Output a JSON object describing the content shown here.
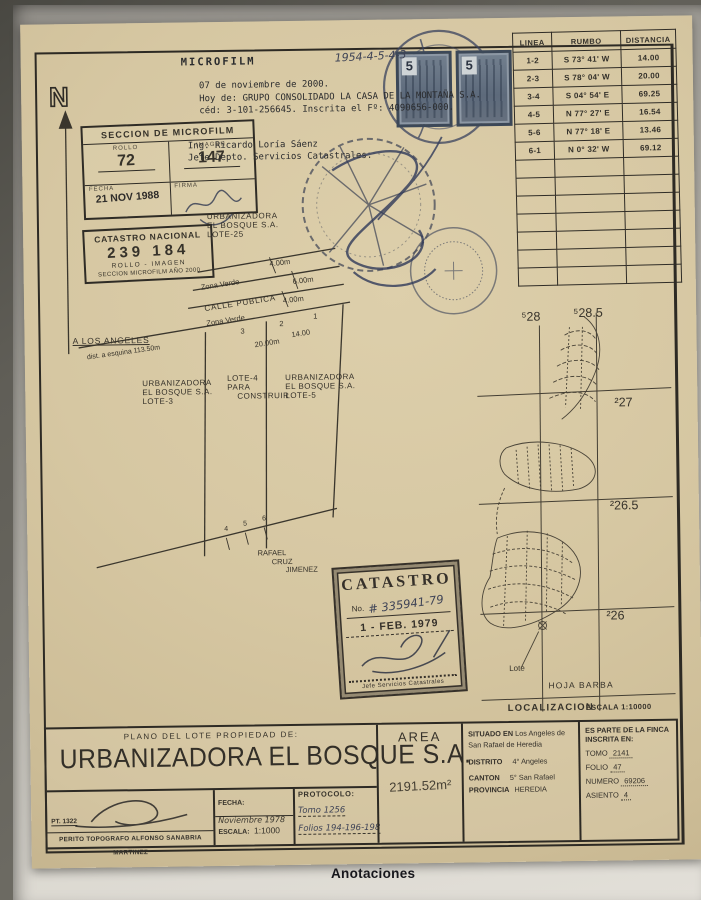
{
  "scan": {
    "annotations_heading": "Anotaciones"
  },
  "header": {
    "microfilm_label": "MICROFILM",
    "handwritten_code": "1954-4-5-4-3",
    "note_lines": [
      "07 de noviembre de 2000.",
      "Hoy de: GRUPO CONSOLIDADO LA CASA DE LA MONTAÑA S.A.",
      "céd: 3-101-256645. Inscrita el Fº: 4090656-000."
    ],
    "engineer_lines": [
      "Ing. Ricardo Loría Sáenz",
      "Jefe Depto. Servicios Catastrales."
    ]
  },
  "revenue_stamps": {
    "denomination": "5"
  },
  "microfilm_box": {
    "title": "SECCION DE MICROFILM",
    "rollo_label": "ROLLO",
    "rollo": "72",
    "imagen_label": "IMAGEN",
    "imagen": "147",
    "fecha_label": "FECHA",
    "fecha_stamp": "21 NOV 1988",
    "firma_label": "FIRMA"
  },
  "catastro_nacional_box": {
    "line1": "CATASTRO NACIONAL",
    "numbers": "239 184",
    "line3": "ROLLO - IMAGEN",
    "line4": "SECCION MICROFILM AÑO 2000"
  },
  "bearing_table": {
    "headers": [
      "LINEA",
      "RUMBO",
      "DISTANCIA"
    ],
    "rows": [
      [
        "1-2",
        "S 73° 41' W",
        "14.00"
      ],
      [
        "2-3",
        "S 78° 04' W",
        "20.00"
      ],
      [
        "3-4",
        "S 04° 54' E",
        "69.25"
      ],
      [
        "4-5",
        "N 77° 27' E",
        "16.54"
      ],
      [
        "5-6",
        "N 77° 18' E",
        "13.46"
      ],
      [
        "6-1",
        "N 0° 32' W",
        "69.12"
      ]
    ]
  },
  "plan": {
    "north_label": "N",
    "lot25_lines": [
      "URBANIZADORA",
      "EL BOSQUE S.A.",
      "LOTE-25"
    ],
    "zona_verde_top": "Zona Verde",
    "zona_verde_top_dim": "4.00m",
    "calle_publica": "CALLE PUBLICA",
    "calle_publica_dim": "6.00m",
    "zona_verde_bottom": "Zona Verde",
    "zona_verde_bottom_dim": "4.00m",
    "to_road": "A LOS ANGELES",
    "corner_distance": "dist. a esquina 113.50m",
    "dim_20": "20.00m",
    "dim_14": "14.00",
    "pt1": "1",
    "pt2": "2",
    "pt3": "3",
    "pt4": "4",
    "pt5": "5",
    "pt6": "6",
    "lot3_lines": [
      "URBANIZADORA",
      "EL BOSQUE S.A.",
      "LOTE-3"
    ],
    "lot4_lines": [
      "LOTE-4",
      "PARA",
      "CONSTRUIR"
    ],
    "lot5_lines": [
      "URBANIZADORA",
      "EL BOSQUE S.A.",
      "LOTE-5"
    ],
    "neighbor_lines": [
      "RAFAEL",
      "CRUZ",
      "JIMENEZ"
    ]
  },
  "catastro_stamp": {
    "title": "CATASTRO",
    "no_label": "No.",
    "number": "# 335941-79",
    "date": "1 - FEB. 1979",
    "footer": "Jefe Servicios Catastrales"
  },
  "location_map": {
    "grid_e": [
      "⁵28",
      "⁵28.5"
    ],
    "grid_n": [
      "²27",
      "²26.5",
      "²26"
    ],
    "lote_label": "Lote",
    "sheet": "HOJA BARBA",
    "caption": "LOCALIZACION",
    "scale": "ESCALA 1:10000"
  },
  "title_block": {
    "subtitle": "PLANO DEL LOTE PROPIEDAD DE:",
    "owner": "URBANIZADORA EL BOSQUE S.A.",
    "pt_number": "PT. 1322",
    "surveyor": "PERITO TOPOGRAFO ALFONSO SANABRIA MARTINEZ",
    "fecha_label": "FECHA:",
    "fecha": "Noviembre 1978",
    "escala_label": "ESCALA:",
    "escala": "1:1000",
    "protocolo_label": "PROTOCOLO:",
    "protocolo_tomo": "Tomo 1256",
    "protocolo_folios": "Folios 194-196-198",
    "area_label": "AREA",
    "area_value": "2191.52m²",
    "situado_label": "SITUADO EN",
    "situado_value": "Los Angeles de San Rafael de Heredia",
    "distrito_label": "DISTRITO",
    "distrito": "4° Angeles",
    "canton_label": "CANTON",
    "canton": "5° San Rafael",
    "provincia_label": "PROVINCIA",
    "provincia": "HEREDIA",
    "finca_line1": "ES PARTE DE LA FINCA",
    "finca_line2": "INSCRITA EN:",
    "tomo_label": "TOMO",
    "tomo": "2141",
    "folio_label": "FOLIO",
    "folio": "47",
    "numero_label": "NUMERO",
    "numero": "69206",
    "asiento_label": "ASIENTO",
    "asiento": "4"
  }
}
